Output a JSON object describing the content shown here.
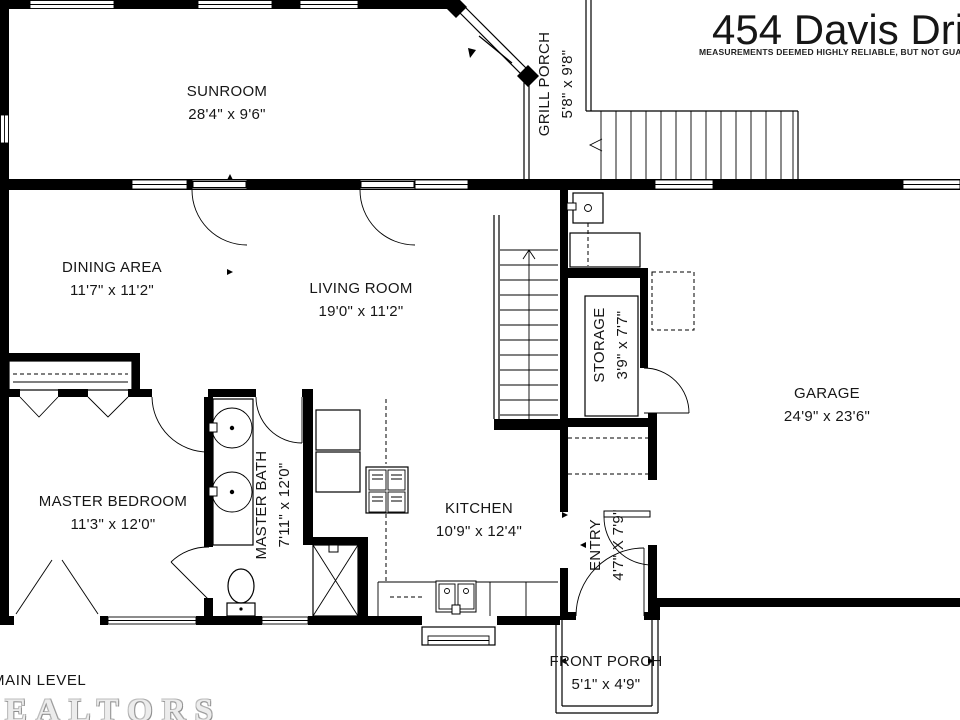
{
  "header": {
    "title": "454 Davis Drive",
    "disclaimer": "MEASUREMENTS DEEMED HIGHLY RELIABLE, BUT NOT GUARANTEED"
  },
  "footer": {
    "level": "MAIN LEVEL",
    "brand": "REALTORS"
  },
  "rooms": {
    "sunroom": {
      "name": "SUNROOM",
      "dims": "28'4\" x 9'6\""
    },
    "grill_porch": {
      "name": "GRILL PORCH",
      "dims": "5'8\" x 9'8\""
    },
    "dining": {
      "name": "DINING AREA",
      "dims": "11'7\" x 11'2\""
    },
    "living": {
      "name": "LIVING ROOM",
      "dims": "19'0\" x 11'2\""
    },
    "storage": {
      "name": "STORAGE",
      "dims": "3'9\" x 7'7\""
    },
    "garage": {
      "name": "GARAGE",
      "dims": "24'9\" x 23'6\""
    },
    "master_bedroom": {
      "name": "MASTER BEDROOM",
      "dims": "11'3\" x 12'0\""
    },
    "master_bath": {
      "name": "MASTER BATH",
      "dims": "7'11\" x 12'0\""
    },
    "kitchen": {
      "name": "KITCHEN",
      "dims": "10'9\" x 12'4\""
    },
    "entry": {
      "name": "ENTRY",
      "dims": "4'7\" X 7'9\""
    },
    "front_porch": {
      "name": "FRONT PORCH",
      "dims": "5'1\" x 4'9\""
    }
  }
}
